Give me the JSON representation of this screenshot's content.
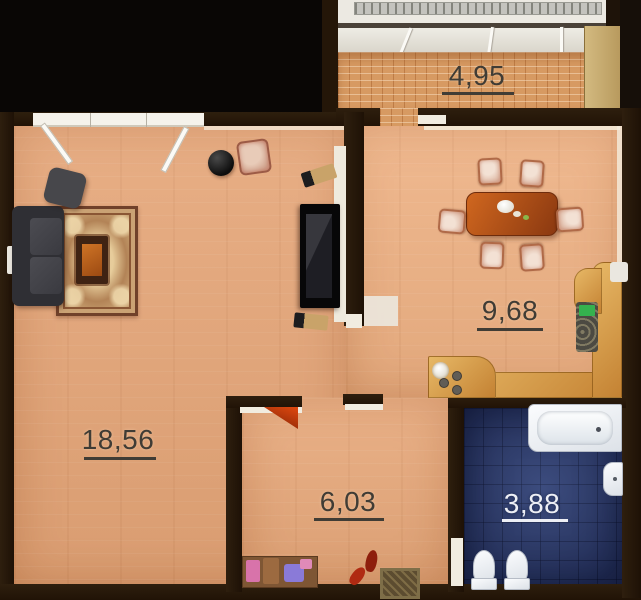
{
  "rooms": {
    "balcony": {
      "area": "4,95"
    },
    "living_room": {
      "area": "18,56"
    },
    "kitchen": {
      "area": "9,68"
    },
    "hallway": {
      "area": "6,03"
    },
    "bathroom": {
      "area": "3,88"
    }
  },
  "colors": {
    "wall": "#281a0b",
    "living_floor": "#e5a577",
    "kitchen_floor": "#eeb183",
    "hallway_floor": "#e7a87a",
    "bathroom_tile": "#2f3e6e",
    "balcony_brick": "#d79a62",
    "counter": "#d9a44c",
    "label_dark": "#403c35",
    "label_light": "#edeff5",
    "door_accent": "#cc3d0e"
  }
}
